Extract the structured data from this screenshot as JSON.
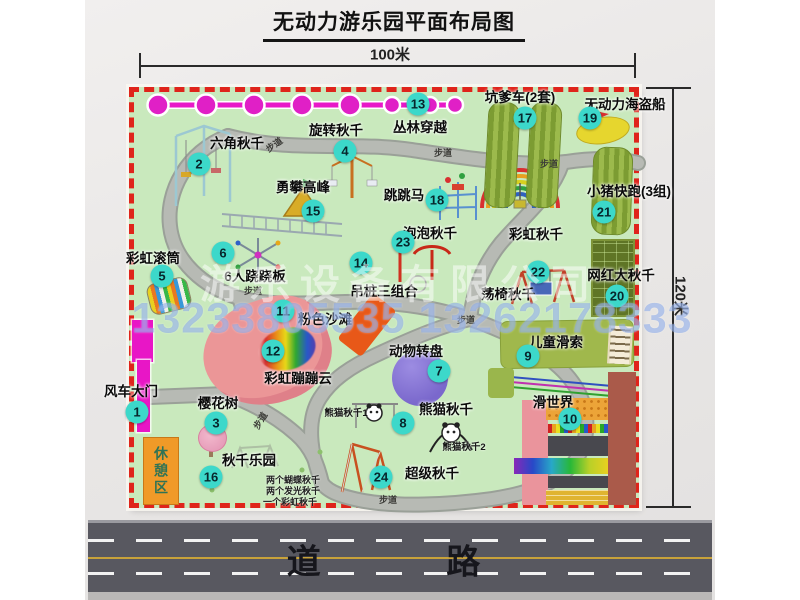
{
  "title": "无动力游乐园平面布局图",
  "dimensions": {
    "width_label": "100米",
    "height_label": "120米"
  },
  "road": {
    "label": "道 路"
  },
  "rest_area": {
    "label": "休憩区"
  },
  "watermark": {
    "company": "游乐设备有限公司",
    "phone": "13233805535 13262178333"
  },
  "path_label": "步道",
  "colors": {
    "map_green": "#c9e9bd",
    "border_red": "#df241b",
    "bubble_cyan": "#3cd8ca",
    "chain_magenta": "#e818c8",
    "gate_magenta": "#e816c6",
    "walkway_gray": "#b7bab4"
  },
  "features": [
    {
      "num": "1",
      "name": "风车大门"
    },
    {
      "num": "2",
      "name": "六角秋千"
    },
    {
      "num": "3",
      "name": "樱花树"
    },
    {
      "num": "4",
      "name": "旋转秋千"
    },
    {
      "num": "5",
      "name": "彩虹滚筒"
    },
    {
      "num": "6",
      "name": "6人跷跷板"
    },
    {
      "num": "7",
      "name": "动物转盘"
    },
    {
      "num": "8",
      "name": "熊猫秋千"
    },
    {
      "num": "9",
      "name": "儿童滑索"
    },
    {
      "num": "10",
      "name": "滑世界"
    },
    {
      "num": "11",
      "name": "粉色沙滩"
    },
    {
      "num": "12",
      "name": "彩虹蹦蹦云"
    },
    {
      "num": "13",
      "name": "丛林穿越"
    },
    {
      "num": "14",
      "name": "吊桩三组合"
    },
    {
      "num": "15",
      "name": "勇攀高峰"
    },
    {
      "num": "16",
      "name": "秋千乐园"
    },
    {
      "num": "17",
      "name": "坑爹车(2套)"
    },
    {
      "num": "18",
      "name": "跳跳马"
    },
    {
      "num": "19",
      "name": "无动力海盗船"
    },
    {
      "num": "20",
      "name": "网红大秋千"
    },
    {
      "num": "21",
      "name": "小猪快跑(3组)"
    },
    {
      "num": "22",
      "name": "荡椅秋千"
    },
    {
      "num": "23",
      "name": "泡泡秋千"
    },
    {
      "num": "24",
      "name": "超级秋千"
    }
  ],
  "extra_labels": {
    "rainbow_swing": "彩虹秋千",
    "panda_swing_1": "熊猫秋千1",
    "panda_swing_2": "熊猫秋千2",
    "swing_list": [
      "两个蝴蝶秋千",
      "两个发光秋千",
      "一个彩虹秋千"
    ]
  }
}
